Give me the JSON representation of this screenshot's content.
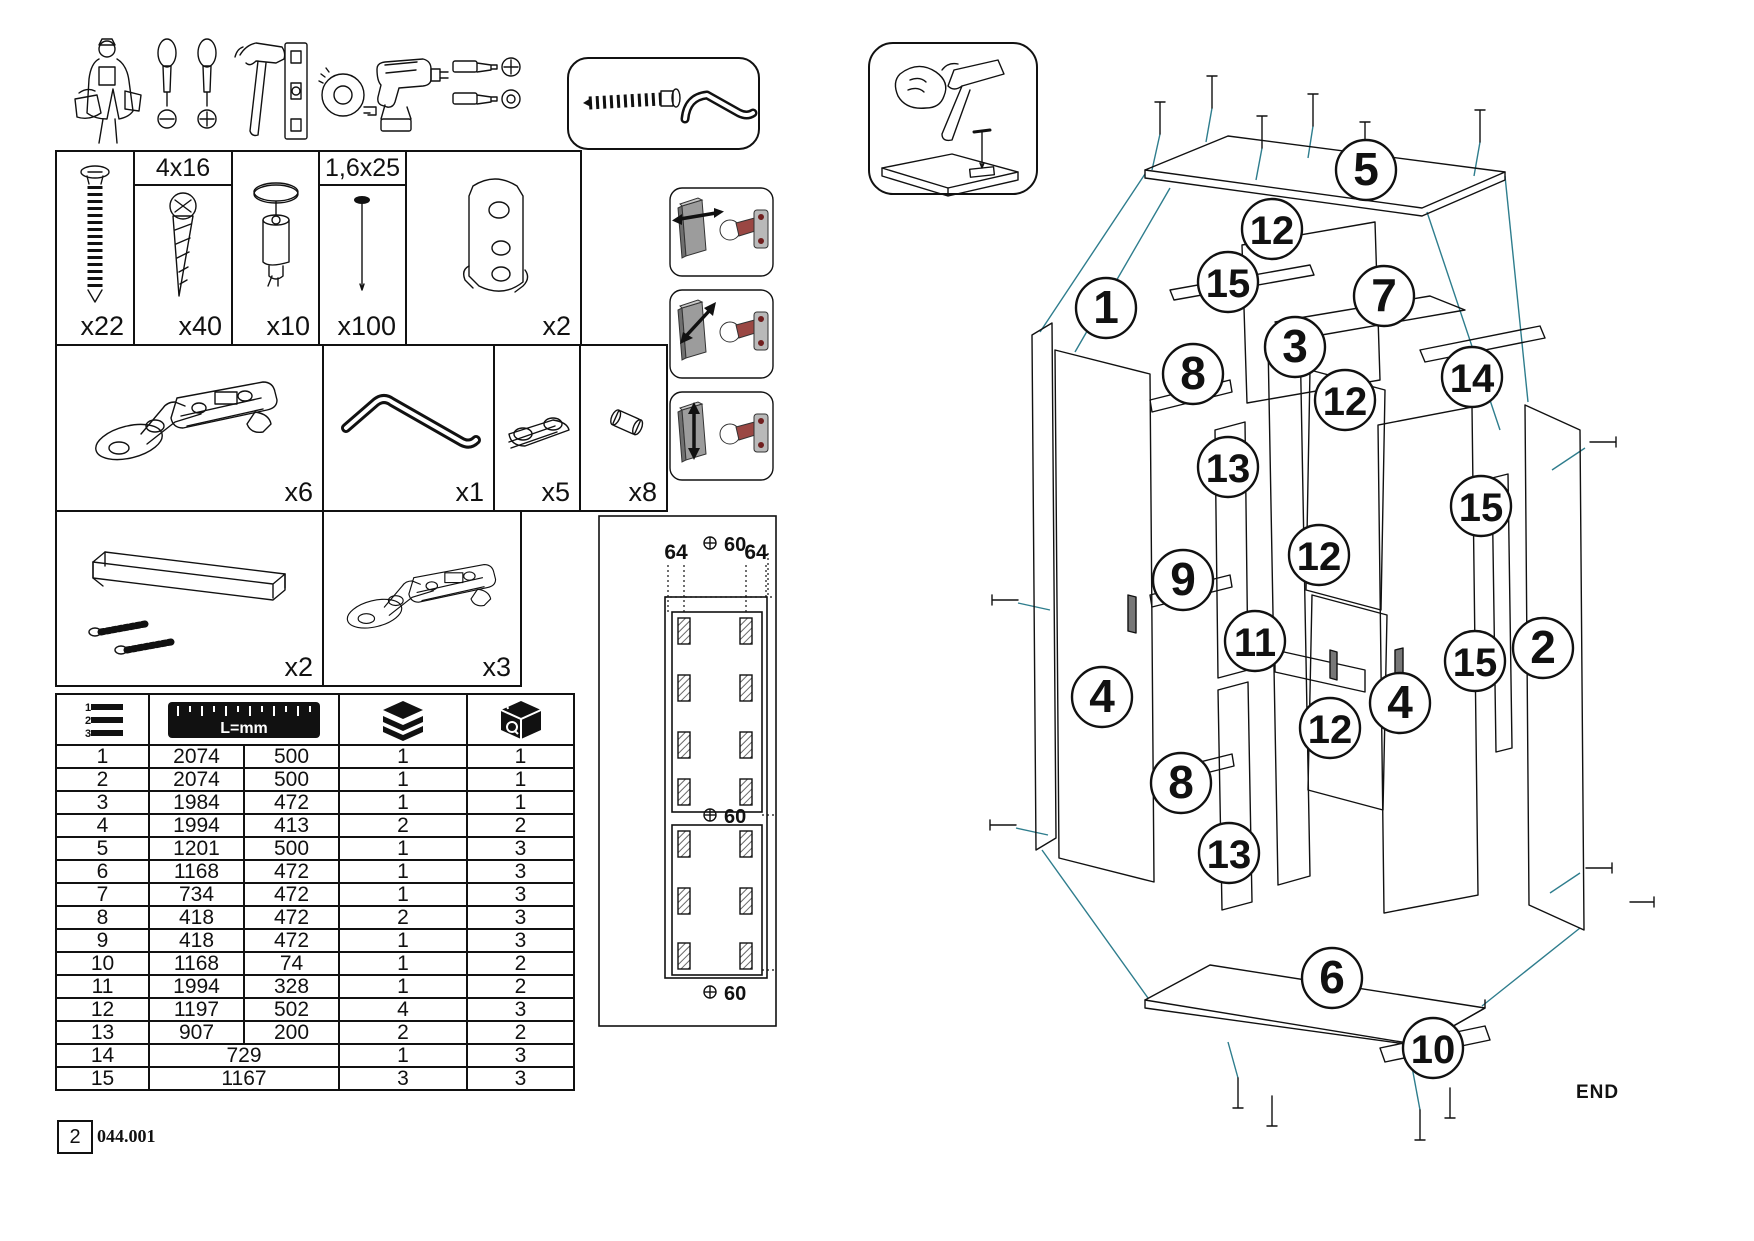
{
  "doc": {
    "page": "2",
    "code": "044.001",
    "end": "END"
  },
  "colors": {
    "leader": "#2e7d8d",
    "hinge_accent": "#9a4743",
    "door_grey": "#9c9c9c",
    "ink": "#111111"
  },
  "tools": [
    "worker",
    "flat-screwdriver",
    "phillips-screwdriver",
    "hammer",
    "spirit-level",
    "tape-measure",
    "drill-driver",
    "phillips-bit",
    "hex-bit"
  ],
  "hardware": {
    "row1": [
      {
        "part": "confirmat-screw",
        "size": "",
        "qty": "x22"
      },
      {
        "part": "wood-screw",
        "size": "4x16",
        "qty": "x40"
      },
      {
        "part": "cam-dowel",
        "size": "",
        "qty": "x10"
      },
      {
        "part": "nail",
        "size": "1,6x25",
        "qty": "x100"
      },
      {
        "part": "hanging-rail-bracket",
        "size": "",
        "qty": "x2"
      }
    ],
    "row2": [
      {
        "part": "hinge",
        "qty": "x6"
      },
      {
        "part": "allen-key",
        "qty": "x1"
      },
      {
        "part": "rail-holder",
        "qty": "x5"
      },
      {
        "part": "shelf-pin",
        "qty": "x8"
      }
    ],
    "row3": [
      {
        "part": "handle-with-screws",
        "qty": "x2"
      },
      {
        "part": "hinge",
        "qty": "x3"
      }
    ]
  },
  "parts_table": {
    "header": {
      "ruler_label": "L=mm"
    },
    "rows": [
      {
        "n": "1",
        "d1": "2074",
        "d2": "500",
        "q1": "1",
        "q2": "1"
      },
      {
        "n": "2",
        "d1": "2074",
        "d2": "500",
        "q1": "1",
        "q2": "1"
      },
      {
        "n": "3",
        "d1": "1984",
        "d2": "472",
        "q1": "1",
        "q2": "1"
      },
      {
        "n": "4",
        "d1": "1994",
        "d2": "413",
        "q1": "2",
        "q2": "2"
      },
      {
        "n": "5",
        "d1": "1201",
        "d2": "500",
        "q1": "1",
        "q2": "3"
      },
      {
        "n": "6",
        "d1": "1168",
        "d2": "472",
        "q1": "1",
        "q2": "3"
      },
      {
        "n": "7",
        "d1": "734",
        "d2": "472",
        "q1": "1",
        "q2": "3"
      },
      {
        "n": "8",
        "d1": "418",
        "d2": "472",
        "q1": "2",
        "q2": "3"
      },
      {
        "n": "9",
        "d1": "418",
        "d2": "472",
        "q1": "1",
        "q2": "3"
      },
      {
        "n": "10",
        "d1": "1168",
        "d2": "74",
        "q1": "1",
        "q2": "2"
      },
      {
        "n": "11",
        "d1": "1994",
        "d2": "328",
        "q1": "1",
        "q2": "2"
      },
      {
        "n": "12",
        "d1": "1197",
        "d2": "502",
        "q1": "4",
        "q2": "3"
      },
      {
        "n": "13",
        "d1": "907",
        "d2": "200",
        "q1": "2",
        "q2": "2"
      },
      {
        "n": "14",
        "d1": "729",
        "d2": null,
        "q1": "1",
        "q2": "3"
      },
      {
        "n": "15",
        "d1": "1167",
        "d2": null,
        "q1": "3",
        "q2": "3"
      }
    ]
  },
  "drill_template": {
    "dim_left": "64",
    "dim_right": "64",
    "offset_top": "60",
    "offset_mid": "60",
    "offset_bottom": "60"
  },
  "balloons": [
    {
      "n": "5",
      "x": 386,
      "y": 120
    },
    {
      "n": "12",
      "x": 292,
      "y": 179
    },
    {
      "n": "15",
      "x": 248,
      "y": 232
    },
    {
      "n": "7",
      "x": 404,
      "y": 246
    },
    {
      "n": "1",
      "x": 126,
      "y": 258
    },
    {
      "n": "3",
      "x": 315,
      "y": 297
    },
    {
      "n": "14",
      "x": 492,
      "y": 327
    },
    {
      "n": "8",
      "x": 213,
      "y": 324
    },
    {
      "n": "12",
      "x": 365,
      "y": 350
    },
    {
      "n": "13",
      "x": 248,
      "y": 417
    },
    {
      "n": "15",
      "x": 501,
      "y": 456
    },
    {
      "n": "12",
      "x": 339,
      "y": 505
    },
    {
      "n": "9",
      "x": 203,
      "y": 530
    },
    {
      "n": "11",
      "x": 275,
      "y": 591
    },
    {
      "n": "15",
      "x": 495,
      "y": 611
    },
    {
      "n": "2",
      "x": 563,
      "y": 598
    },
    {
      "n": "4",
      "x": 122,
      "y": 647
    },
    {
      "n": "4",
      "x": 420,
      "y": 653
    },
    {
      "n": "12",
      "x": 350,
      "y": 678
    },
    {
      "n": "8",
      "x": 201,
      "y": 733
    },
    {
      "n": "13",
      "x": 249,
      "y": 803
    },
    {
      "n": "6",
      "x": 352,
      "y": 928
    },
    {
      "n": "10",
      "x": 453,
      "y": 998
    }
  ]
}
